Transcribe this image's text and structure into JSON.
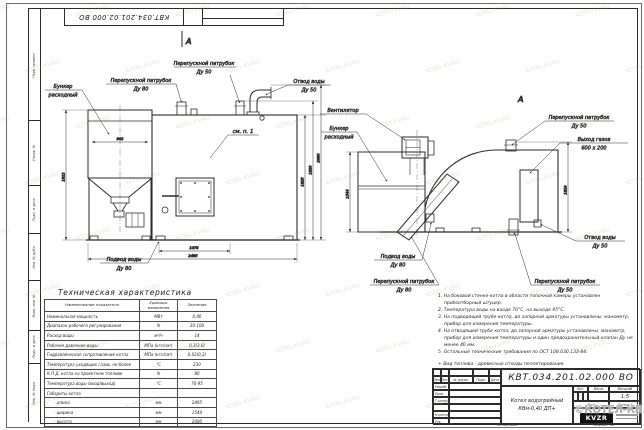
{
  "frame": {
    "stamp_number": "КВТ.034.201.02.000 ВО",
    "margin_labels": [
      "Перв. примен.",
      "Справ. №",
      "Подп. и дата",
      "Инв. № дубл.",
      "Взам. инв. №",
      "Подп. и дата",
      "Инв. № подл."
    ],
    "copied_label": "Копировал",
    "format_label": "Формат А3"
  },
  "watermark": {
    "tile": "KOTEL-KV.RU",
    "copyright": "©КОТЕЛ-КВ.РФ2021"
  },
  "front_view": {
    "section_mark": "А",
    "labels": {
      "bypass50": [
        "Перепускной патрубок",
        "Ду 50"
      ],
      "bypass80": [
        "Перепускной патрубок",
        "Ду 80"
      ],
      "bunker": [
        "Бункер",
        "расходный"
      ],
      "water_out": [
        "Отвод воды",
        "Ду 50"
      ],
      "see_note": "см. п. 1",
      "water_in": [
        "Подвод воды",
        "Ду 80"
      ]
    },
    "dims": {
      "bunker_width": "902",
      "left_height": "1912",
      "h1": "1825",
      "h2": "1920",
      "h3": "2080",
      "w1": "1078",
      "w2": "2495"
    }
  },
  "side_view": {
    "view_mark": "А",
    "labels": {
      "fan": "Вентилятор",
      "bunker": [
        "Бункер",
        "расходный"
      ],
      "bypass50_top": [
        "Перепускной патрубок",
        "Ду 50"
      ],
      "gas_out": [
        "Выход газов",
        "600 х 200"
      ],
      "water_out": [
        "Отвод воды",
        "Ду 50"
      ],
      "water_in": [
        "Подвод воды",
        "Ду 80"
      ],
      "bypass80": [
        "Перепускной патрубок",
        "Ду 80"
      ],
      "bypass50_bottom": [
        "Перепускной патрубок",
        "Ду 50"
      ]
    },
    "dims": {
      "left_height": "1544",
      "right_height": "1818"
    }
  },
  "spec_table": {
    "title": "Техническая характеристика",
    "headers": [
      "Наименование показателя",
      "Единицы измерения",
      "Значение"
    ],
    "rows": [
      [
        "Номинальная мощность",
        "МВт",
        "0,40"
      ],
      [
        "Диапазон рабочего регулирования",
        "%",
        "30-100"
      ],
      [
        "Расход воды",
        "м³/ч",
        "14"
      ],
      [
        "Рабочее давление воды",
        "МПа (кгс/см²)",
        "0,3(3,0)"
      ],
      [
        "Гидравлическое сопротивление котла",
        "МПа (кгс/см²)",
        "0,02(0,2)"
      ],
      [
        "Температура уходящих газов, не более",
        "°С",
        "230"
      ],
      [
        "К.П.Д. котла на проектном топливе",
        "%",
        "80"
      ],
      [
        "Температура воды (вход/выход)",
        "°С",
        "70-95"
      ],
      [
        "Габариты котла",
        "",
        ""
      ],
      [
        "- длина",
        "мм",
        "2495"
      ],
      [
        "- ширина",
        "мм",
        "1544"
      ],
      [
        "- высота",
        "мм",
        "2080"
      ]
    ]
  },
  "notes": [
    "1.  На боковой стенке котла в области топочной камеры установлен пробоотборный штуцер.",
    "2.  Температура воды на входе 70°С, на выходе 95°С.",
    "3.  На подводящей трубе котла, до запорной арматуры установлены: манометр, прибор для измерения температуры.",
    "4.  На отводящей трубе котла, до запорной арматуры установлены: манометр, прибор для измерения температуры и один предохранительный клапан Ду не менее 40 мм.",
    "5.  Остальные технические требования по ОСТ 108.030.133-84.",
    "+  Вид топлива - древесные отходы пеллетирования."
  ],
  "title_block": {
    "number": "КВТ.034.201.02.000 ВО",
    "name_line1": "Котел водогрейный",
    "name_line2": "КВм-0,40 ДП+",
    "col_headers": [
      "Изм.",
      "Лист",
      "№ докум.",
      "Подп.",
      "Дата"
    ],
    "roles": [
      "Разраб.",
      "Пров.",
      "Т.контр.",
      "",
      "Н.контр.",
      "Утв."
    ],
    "lit_label": "Лит.",
    "mass_label": "Масса",
    "scale_label": "Масштаб",
    "scale_value": "1:5",
    "sheet_label": "Лист",
    "sheets_label": "Листов 1",
    "logo": "KVZR"
  }
}
